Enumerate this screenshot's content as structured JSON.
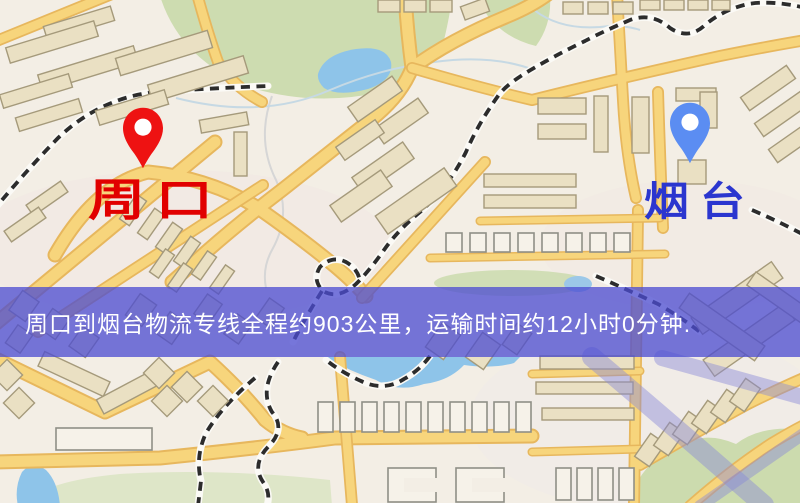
{
  "map": {
    "origin": {
      "label": "周口",
      "pin_color": "#ee1212",
      "label_color": "#e10000"
    },
    "destination": {
      "label": "烟台",
      "pin_color": "#5b8df2",
      "label_color": "#2b36cf"
    },
    "banner": {
      "text": "周口到烟台物流专线全程约903公里，运输时间约12小时0分钟.",
      "background_color": "#4c4cd1",
      "text_color": "#ffffff",
      "distance_km": "903",
      "duration_hours": "12",
      "duration_minutes": "0"
    },
    "icons": {
      "origin_pin": "map-pin",
      "destination_pin": "map-pin"
    },
    "palette": {
      "map_background": "#f3eee5",
      "road_yellow": "#f7d57c",
      "green_area": "#cddcb0",
      "water_blue": "#8ec4e9",
      "railway": "#2c2c2c"
    }
  }
}
